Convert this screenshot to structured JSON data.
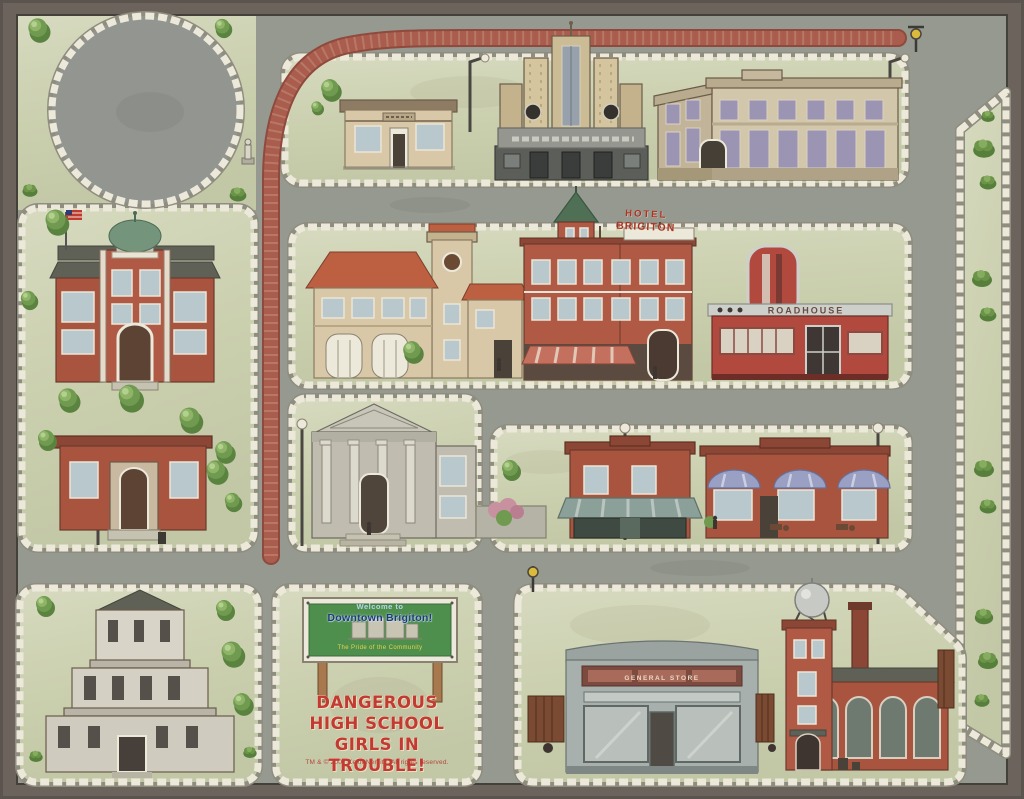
{
  "board": {
    "welcome_sign": {
      "line1": "Welcome to",
      "line2": "Downtown Brigiton!",
      "tagline": "The Pride of the Community"
    },
    "game_title": {
      "line1": "Dangerous",
      "line2": "High School",
      "line3": "Girls in Trouble!",
      "copyright": "TM & © 2007 Keith Nemitz. All rights reserved."
    },
    "hotel_sign": {
      "line1": "HOTEL",
      "line2": "BRIGITON"
    },
    "diner_sign": "ROADHOUSE",
    "general_store_sign": "GENERAL STORE",
    "landmarks": [
      "small-shop",
      "movie-theater",
      "department-store",
      "schoolhouse",
      "library",
      "firehouse",
      "hotel-brigiton",
      "diner",
      "bank",
      "awning-shop",
      "cafe",
      "courthouse",
      "general-store",
      "factory",
      "welcome-billboard",
      "traffic-circle"
    ],
    "colors": {
      "frame": "#6b635c",
      "road": "#96998f",
      "block": "#cdd2b6",
      "brick_road": "#aa5d4d",
      "curb": "#ece9da",
      "sign_green": "#4e8f4e",
      "title_red": "#c23a31"
    }
  }
}
